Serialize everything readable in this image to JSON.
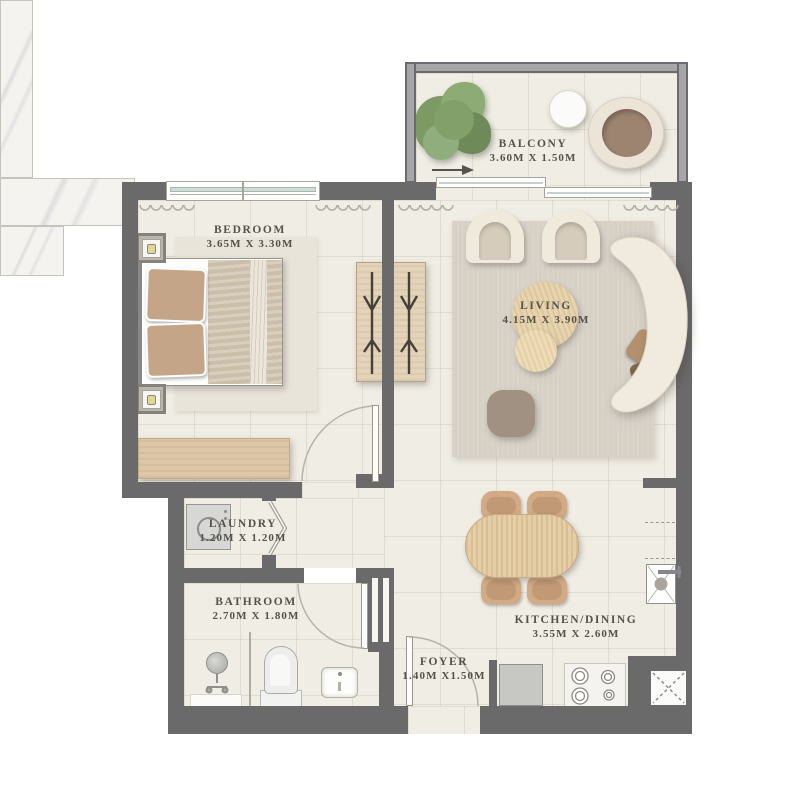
{
  "plan_title": "One-bedroom apartment floor plan",
  "rooms": {
    "balcony": {
      "label": "BALCONY",
      "dims": "3.60M X 1.50M"
    },
    "bedroom": {
      "label": "BEDROOM",
      "dims": "3.65M X 3.30M"
    },
    "living": {
      "label": "LIVING",
      "dims": "4.15M X 3.90M"
    },
    "laundry": {
      "label": "LAUNDRY",
      "dims": "1.20M X 1.20M"
    },
    "bathroom": {
      "label": "BATHROOM",
      "dims": "2.70M X 1.80M"
    },
    "kitchen_dining": {
      "label": "KITCHEN/DINING",
      "dims": "3.55M X 2.60M"
    },
    "foyer": {
      "label": "FOYER",
      "dims": "1.40M X1.50M"
    }
  },
  "colors": {
    "wall": "#6a6a6a",
    "floor": "#f0ede4",
    "rug_living": "#d6d0c5",
    "rug_bedroom": "#e9e4d9",
    "wood": "#ddc7a8",
    "label_text": "#55524a",
    "greenery": "#7c9a63"
  }
}
